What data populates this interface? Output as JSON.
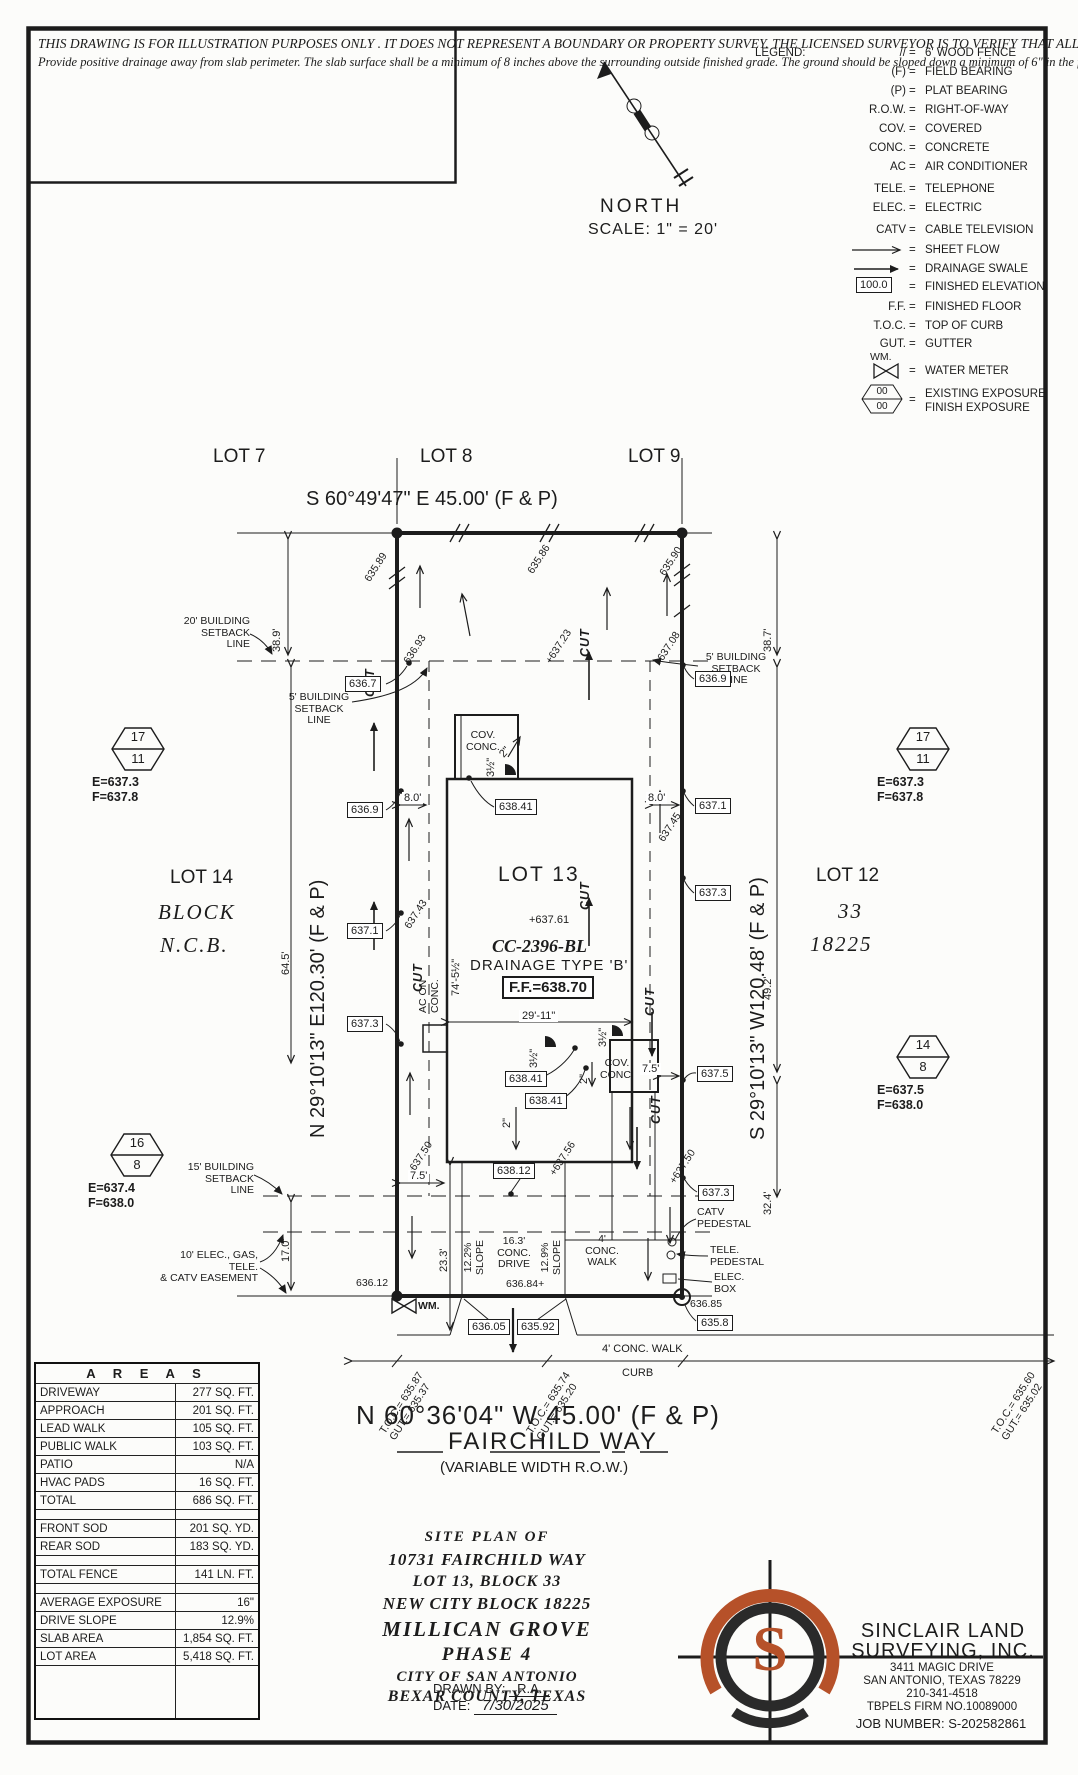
{
  "colors": {
    "ink": "#1c1c1c",
    "accent_orange": "#b65129",
    "paper": "#fcfcfa"
  },
  "disclaimer": {
    "caps": "THIS DRAWING IS FOR ILLUSTRATION PURPOSES ONLY . IT DOES NOT REPRESENT A BOUNDARY OR PROPERTY SURVEY. THE LICENSED SURVEYOR IS TO VERIFY THAT ALL INFORMATION CONTAINED HEREIN IS ACCURATE PRIOR TO PLACING HOUSE PINS.",
    "note": "Provide positive drainage away from slab perimeter. The slab surface shall be a minimum of 8 inches above the surrounding outside finished grade. The ground should be sloped down a minimum of 6\" in the first five feet and any resulting swale shall have a minimum slope of 1.0%."
  },
  "north": {
    "label": "NORTH",
    "scale": "SCALE: 1\" = 20'"
  },
  "legend": {
    "title": "LEGEND:",
    "eq": "=",
    "items": {
      "fence": {
        "sym": "//",
        "desc": "6' WOOD FENCE"
      },
      "field": {
        "sym": "(F)",
        "desc": "FIELD BEARING"
      },
      "plat": {
        "sym": "(P)",
        "desc": "PLAT BEARING"
      },
      "row": {
        "sym": "R.O.W.",
        "desc": "RIGHT-OF-WAY"
      },
      "cov": {
        "sym": "COV.",
        "desc": "COVERED"
      },
      "conc": {
        "sym": "CONC.",
        "desc": "CONCRETE"
      },
      "ac": {
        "sym": "AC",
        "desc": "AIR CONDITIONER"
      },
      "tele": {
        "sym": "TELE.",
        "desc": "TELEPHONE"
      },
      "elec": {
        "sym": "ELEC.",
        "desc": "ELECTRIC"
      },
      "catv": {
        "sym": "CATV",
        "desc": "CABLE TELEVISION"
      },
      "sheet_flow": {
        "desc": "SHEET FLOW"
      },
      "swale": {
        "desc": "DRAINAGE SWALE"
      },
      "fin_elev": {
        "sym": "100.0",
        "desc": "FINISHED ELEVATION"
      },
      "ff": {
        "sym": "F.F.",
        "desc": "FINISHED FLOOR"
      },
      "toc": {
        "sym": "T.O.C.",
        "desc": "TOP OF CURB"
      },
      "gut": {
        "sym": "GUT.",
        "desc": "GUTTER"
      },
      "wm": {
        "sym": "WM.",
        "desc": "WATER METER"
      },
      "exposure": {
        "top": "00",
        "bottom": "00",
        "desc1": "EXISTING EXPOSURE",
        "desc2": "FINISH EXPOSURE"
      }
    }
  },
  "lots": {
    "lot7": "LOT 7",
    "lot8": "LOT 8",
    "lot9": "LOT 9",
    "lot12": "LOT 12",
    "lot13": "LOT 13",
    "lot14": "LOT 14",
    "block_left1": "BLOCK",
    "block_left2": "N.C.B.",
    "block_right1": "33",
    "block_right2": "18225"
  },
  "bearings": {
    "top": "S 60°49'47\" E 45.00' (F & P)",
    "left": "N 29°10'13\" E120.30' (F & P)",
    "right": "S 29°10'13\" W120.48' (F & P)",
    "bottom": "N 60°36'04\" W 45.00' (F & P)"
  },
  "street": {
    "name": "FAIRCHILD WAY",
    "row": "(VARIABLE WIDTH R.O.W.)"
  },
  "exposures": {
    "left_upper": {
      "top": "17",
      "bottom": "11",
      "e": "E=637.3",
      "f": "F=637.8"
    },
    "right_upper": {
      "top": "17",
      "bottom": "11",
      "e": "E=637.3",
      "f": "F=637.8"
    },
    "right_lower": {
      "top": "14",
      "bottom": "8",
      "e": "E=637.5",
      "f": "F=638.0"
    },
    "left_lower": {
      "top": "16",
      "bottom": "8",
      "e": "E=637.4",
      "f": "F=638.0"
    }
  },
  "callouts": {
    "setback20": "20' BUILDING\nSETBACK LINE",
    "setback5_left": "5' BUILDING\nSETBACK LINE",
    "setback5_right": "5' BUILDING\nSETBACK LINE",
    "setback15": "15' BUILDING\nSETBACK LINE",
    "easement10": "10' ELEC., GAS, TELE.\n& CATV EASEMENT",
    "catv_pedestal": "CATV\nPEDESTAL",
    "tele_pedestal": "TELE.\nPEDESTAL",
    "elec_box": "ELEC.\nBOX",
    "wm": "WM.",
    "cut": "CUT",
    "ac_on_conc": "AC ON\nCONC.",
    "cov_conc": "COV.\nCONC.",
    "conc_drive": "16.3'\nCONC.\nDRIVE",
    "conc_walk_plan": "4'\nCONC.\nWALK",
    "conc_walk_street": "4' CONC. WALK",
    "slope_left": "12.2%\nSLOPE",
    "slope_right": "12.9%\nSLOPE",
    "curb": "CURB"
  },
  "house": {
    "spot": "+637.61",
    "cc": "CC-2396-BL",
    "type": "DRAINAGE TYPE 'B'",
    "ff": "F.F.=638.70"
  },
  "boxes": {
    "b636_7": "636.7",
    "b636_9l": "636.9",
    "b637_1l": "637.1",
    "b637_3l": "637.3",
    "b636_9r": "636.9",
    "b637_1r": "637.1",
    "b637_3r": "637.3",
    "b637_5r": "637.5",
    "b637_3r2": "637.3",
    "b635_8": "635.8",
    "b638_41a": "638.41",
    "b638_41b": "638.41",
    "b638_41c": "638.41",
    "b638_12": "638.12",
    "b636_05": "636.05",
    "b635_92": "635.92"
  },
  "spots": {
    "s635_89": "635.89",
    "s636_93": "636.93",
    "s637_43": "637.43",
    "s637_50l": "+637.50",
    "s635_86": "635.86",
    "s637_23": "+637.23",
    "s635_90": "635.90",
    "s637_08": "637.08",
    "s637_45": "637.45",
    "s637_50r": "+637.50",
    "s637_56": "+637.56",
    "s636_84": "636.84+",
    "s636_12": "636.12",
    "s636_85": "636.85"
  },
  "dims": {
    "d38_9": "38.9'",
    "d38_7": "38.7'",
    "d64_5": "64.5'",
    "d49_2": "49.2'",
    "d32_4": "32.4'",
    "d17_0": "17.0'",
    "d8_0": "8.0'",
    "d7_5": "7.5'",
    "d23_3": "23.3'",
    "d2in": "2\"",
    "d3half": "3½\"",
    "w29": "29'-11\"",
    "h74": "74'-5½\""
  },
  "toc_groups": {
    "left": "T.O.C.= 635.87\nGUT.= 635.37",
    "mid": "T.O.C.= 635.74\nGUT.= 635.20",
    "right": "T.O.C.= 635.60\nGUT.= 635.02"
  },
  "areas": {
    "title": "A R E A S",
    "rows": [
      {
        "label": "DRIVEWAY",
        "value": "277 SQ. FT."
      },
      {
        "label": "APPROACH",
        "value": "201 SQ. FT."
      },
      {
        "label": "LEAD WALK",
        "value": "105 SQ. FT."
      },
      {
        "label": "PUBLIC WALK",
        "value": "103 SQ. FT."
      },
      {
        "label": "PATIO",
        "value": "N/A"
      },
      {
        "label": "HVAC PADS",
        "value": "16 SQ. FT."
      },
      {
        "label": "TOTAL",
        "value": "686 SQ. FT."
      },
      {
        "label": "",
        "value": ""
      },
      {
        "label": "FRONT SOD",
        "value": "201 SQ. YD."
      },
      {
        "label": "REAR SOD",
        "value": "183 SQ. YD."
      },
      {
        "label": "",
        "value": ""
      },
      {
        "label": "TOTAL FENCE",
        "value": "141 LN. FT."
      },
      {
        "label": "",
        "value": ""
      },
      {
        "label": "AVERAGE EXPOSURE",
        "value": "16\""
      },
      {
        "label": "DRIVE SLOPE",
        "value": "12.9%"
      },
      {
        "label": "SLAB AREA",
        "value": "1,854 SQ. FT."
      },
      {
        "label": "LOT AREA",
        "value": "5,418 SQ. FT."
      }
    ]
  },
  "title_block": {
    "l1": "SITE PLAN OF",
    "l2": "10731 FAIRCHILD WAY",
    "l3": "LOT 13, BLOCK 33",
    "l4": "NEW CITY BLOCK 18225",
    "l5": "MILLICAN GROVE",
    "l6": "PHASE 4",
    "l7": "CITY OF SAN ANTONIO",
    "l8": "BEXAR COUNTY, TEXAS",
    "drawn_label": "DRAWN BY:",
    "drawn": "R.A.",
    "date_label": "DATE:",
    "date": "7/30/2025"
  },
  "firm": {
    "logo_letter": "S",
    "name1": "SINCLAIR LAND",
    "name2": "SURVEYING, INC.",
    "addr1": "3411 MAGIC DRIVE",
    "addr2": "SAN ANTONIO, TEXAS 78229",
    "phone": "210-341-4518",
    "tbpels": "TBPELS FIRM NO.10089000",
    "job": "JOB NUMBER: S-202582861"
  }
}
